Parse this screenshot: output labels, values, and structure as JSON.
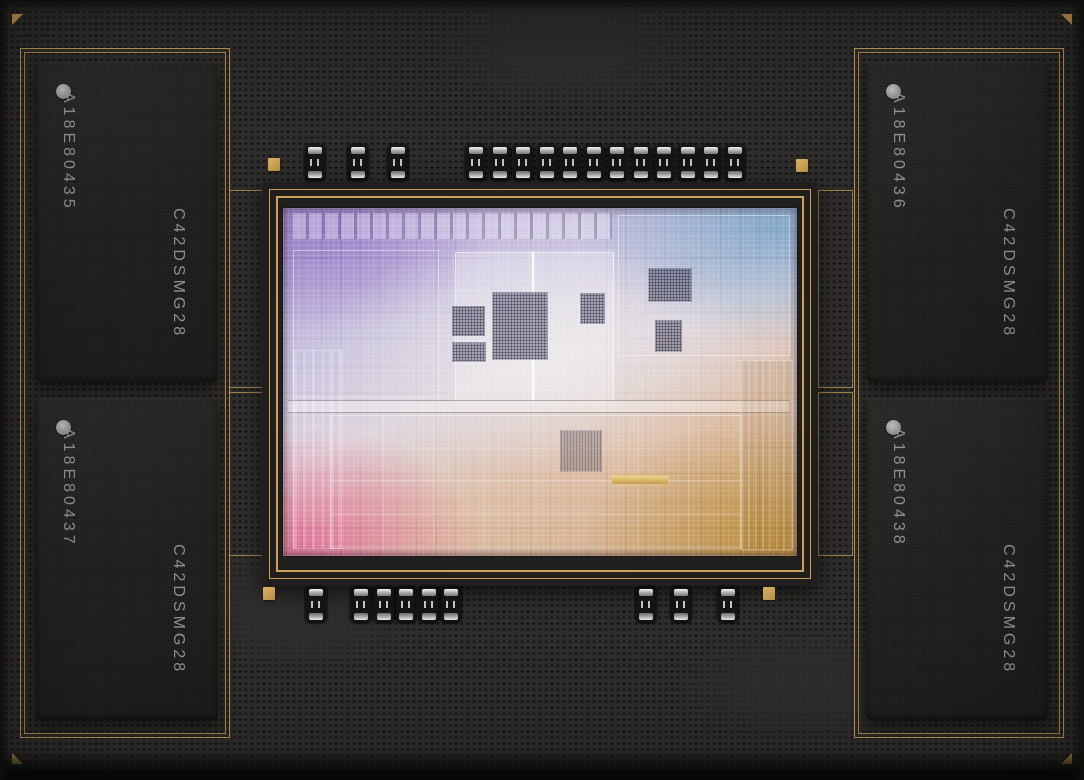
{
  "package": {
    "name": "Apple silicon chip package with unified memory",
    "memory_modules": [
      {
        "position": "top-left",
        "marking_line1": "A18E80435",
        "marking_line2": "C42DSMG28"
      },
      {
        "position": "top-right",
        "marking_line1": "A18E80436",
        "marking_line2": "C42DSMG28"
      },
      {
        "position": "bottom-left",
        "marking_line1": "A18E80437",
        "marking_line2": "C42DSMG28"
      },
      {
        "position": "bottom-right",
        "marking_line1": "A18E80438",
        "marking_line2": "C42DSMG28"
      }
    ],
    "components": {
      "top_row_single_capacitors": 3,
      "top_row_group_capacitors": 12,
      "bottom_row_left_single_capacitors": 1,
      "bottom_row_group_capacitors": 5,
      "bottom_row_right_single_capacitors": 3,
      "gold_pads": 4,
      "corner_fiducial_triangles": 4
    },
    "colors": {
      "gold_trace": "#c79c52",
      "package_surface": "#2e2d2b",
      "memory_chip_body": "#1e1e1d",
      "chip_marking_text": "#9a9a9a",
      "die_purple": "#a391cf",
      "die_blue": "#93b6d2",
      "die_pink": "#dd8ba6",
      "die_gold": "#c49a58",
      "die_silver": "#e6e2e4"
    }
  }
}
